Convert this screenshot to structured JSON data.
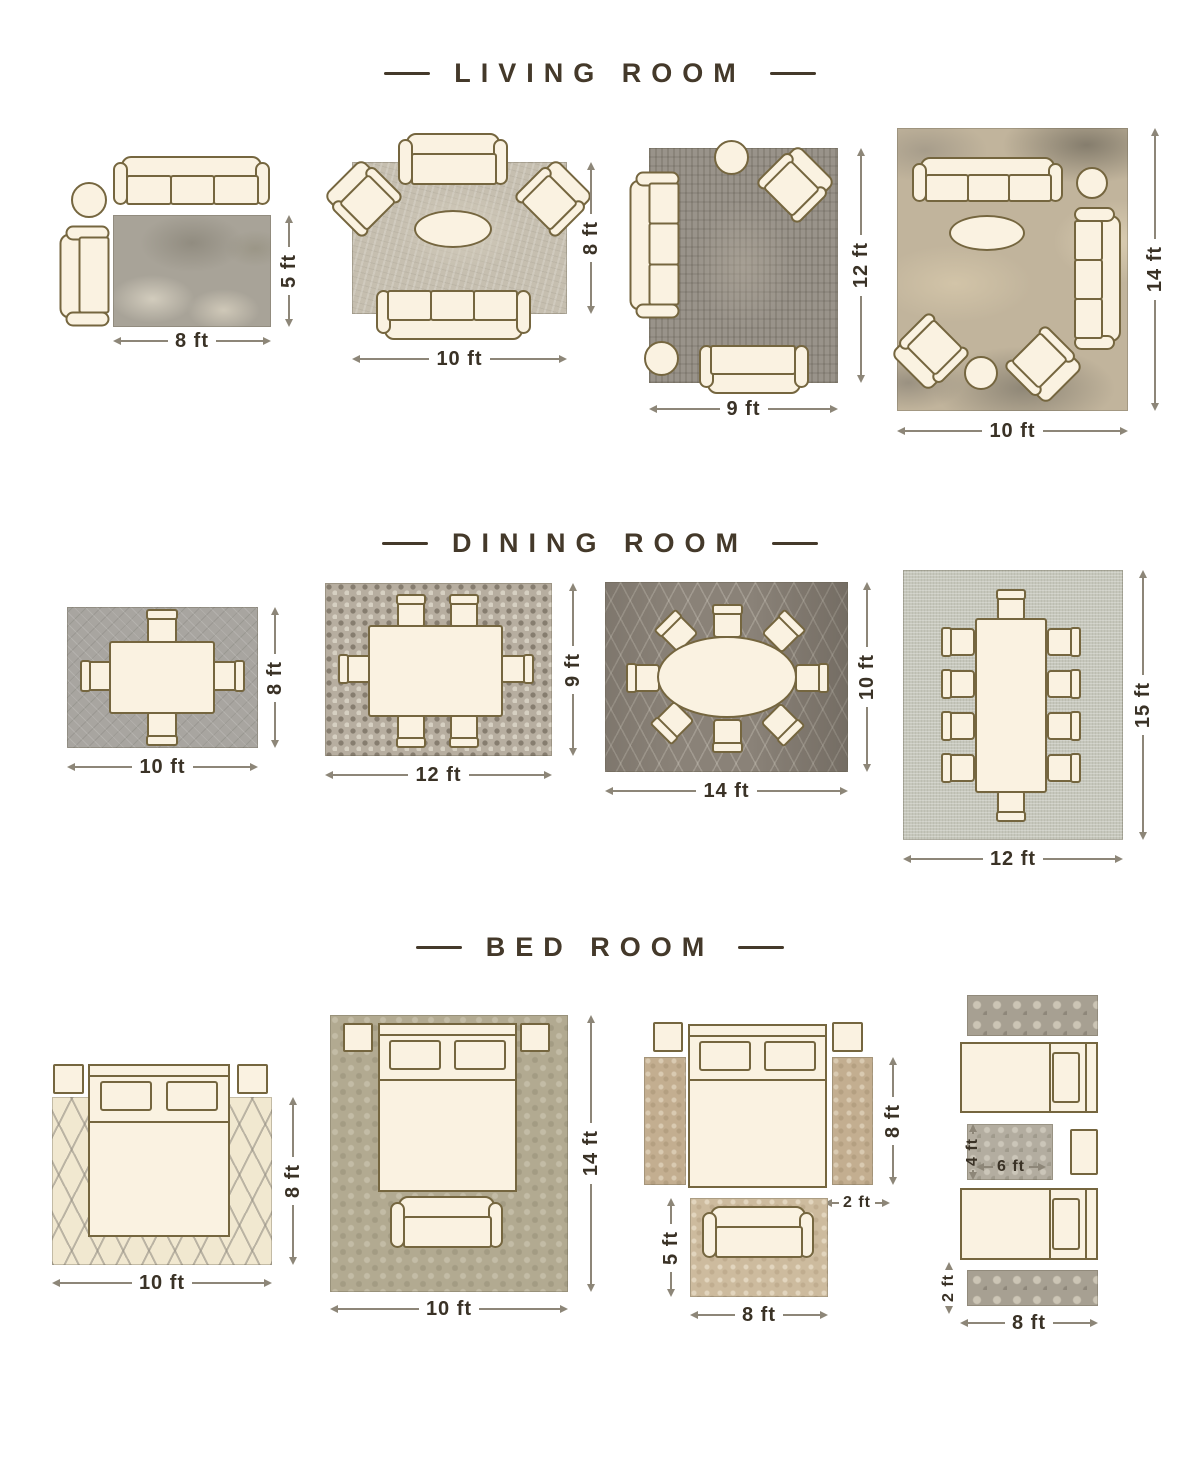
{
  "palette": {
    "outline": "#75663f",
    "furniture_fill": "#faf2e1",
    "dimension_text": "#3a3226",
    "dimension_line": "#8d8678",
    "heading_text": "#44392a",
    "background": "#ffffff"
  },
  "sections": [
    {
      "title": "LIVING ROOM",
      "layouts": [
        {
          "name": "living-8x5",
          "width_label": "8 ft",
          "height_label": "5 ft"
        },
        {
          "name": "living-10x8",
          "width_label": "10 ft",
          "height_label": "8 ft"
        },
        {
          "name": "living-9x12",
          "width_label": "9 ft",
          "height_label": "12 ft"
        },
        {
          "name": "living-10x14",
          "width_label": "10 ft",
          "height_label": "14 ft"
        }
      ]
    },
    {
      "title": "DINING ROOM",
      "layouts": [
        {
          "name": "dining-10x8",
          "width_label": "10 ft",
          "height_label": "8 ft"
        },
        {
          "name": "dining-12x9",
          "width_label": "12 ft",
          "height_label": "9 ft"
        },
        {
          "name": "dining-14x10",
          "width_label": "14 ft",
          "height_label": "10 ft"
        },
        {
          "name": "dining-12x15",
          "width_label": "12 ft",
          "height_label": "15 ft"
        }
      ]
    },
    {
      "title": "BED ROOM",
      "layouts": [
        {
          "name": "bed-10x8",
          "width_label": "10 ft",
          "height_label": "8 ft"
        },
        {
          "name": "bed-10x14",
          "width_label": "10 ft",
          "height_label": "14 ft"
        },
        {
          "name": "bed-runners",
          "runner_height_label": "8 ft",
          "runner_width_label": "2 ft",
          "sofa_rug_height_label": "5 ft",
          "sofa_rug_width_label": "8 ft"
        },
        {
          "name": "bed-twin",
          "middle_rug_height_label": "4 ft",
          "middle_rug_width_label": "6 ft",
          "runner_width_label": "2 ft",
          "width_label": "8 ft"
        }
      ]
    }
  ]
}
